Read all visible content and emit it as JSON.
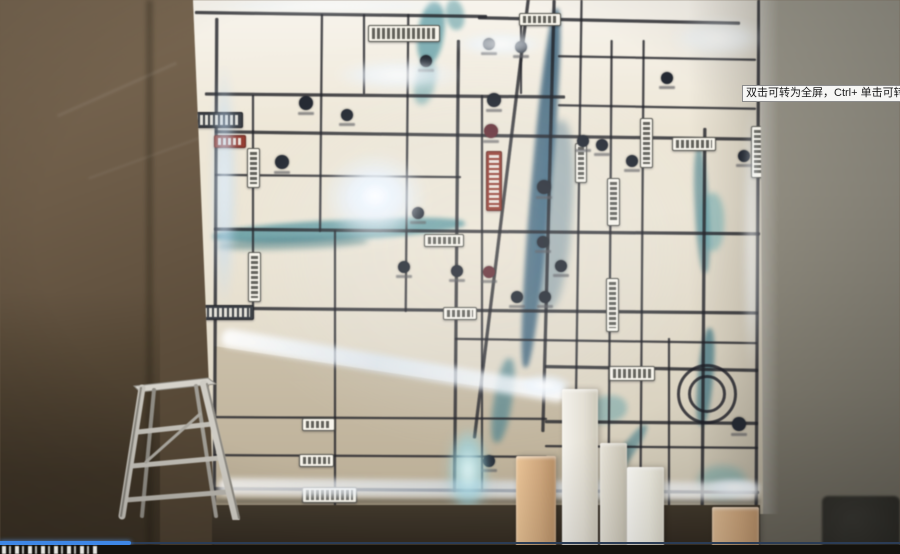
{
  "overlay": {
    "tooltip_text": "双击可转为全屏，Ctrl+ 单击可转为",
    "progress": {
      "fraction": 0.146,
      "bar_color": "#3e87e6",
      "track_color": "#2b3c55"
    }
  },
  "palette": {
    "wall_brown": "#6e5c46",
    "wall_gray": "#908c7f",
    "map_white": "#ece5d4",
    "map_tan": "#c5b8a0",
    "road_dark": "#23242a",
    "river_teal": "#47909b",
    "river_blue": "#2e5a78",
    "led_white": "#ffffff",
    "led_cyan": "#aadeea",
    "sign_red": "#9a3d31",
    "logo_dark": "#252a34",
    "logo_maroon": "#6a3038"
  },
  "map": {
    "v_roads": [
      [
        214,
        18,
        492,
        3,
        0.3
      ],
      [
        252,
        95,
        212,
        2,
        0
      ],
      [
        320,
        14,
        218,
        2,
        0.5
      ],
      [
        334,
        230,
        278,
        2,
        0
      ],
      [
        363,
        14,
        80,
        2,
        0
      ],
      [
        406,
        14,
        298,
        2,
        0.5
      ],
      [
        455,
        40,
        452,
        2.5,
        0.5
      ],
      [
        481,
        95,
        397,
        2,
        0
      ],
      [
        520,
        14,
        80,
        2,
        0
      ],
      [
        547,
        0,
        432,
        3,
        1.5
      ],
      [
        577,
        0,
        508,
        2,
        0.8
      ],
      [
        609,
        40,
        468,
        2,
        0.4
      ],
      [
        641,
        40,
        468,
        2,
        0.4
      ],
      [
        668,
        338,
        170,
        2,
        0
      ],
      [
        702,
        128,
        382,
        2.5,
        0.4
      ],
      [
        756,
        0,
        510,
        3,
        0.3
      ],
      [
        500,
        -5,
        445,
        3,
        7
      ]
    ],
    "h_roads": [
      [
        195,
        13,
        292,
        3,
        0.8
      ],
      [
        478,
        19,
        262,
        2.5,
        1.2
      ],
      [
        558,
        57,
        198,
        2,
        1
      ],
      [
        205,
        94,
        360,
        3,
        0.5
      ],
      [
        558,
        106,
        198,
        2,
        1
      ],
      [
        215,
        134,
        542,
        2.5,
        0.8
      ],
      [
        215,
        175,
        246,
        2,
        0.5
      ],
      [
        214,
        230,
        546,
        3,
        0.5
      ],
      [
        196,
        309,
        562,
        3,
        0.5
      ],
      [
        455,
        340,
        302,
        2,
        0.8
      ],
      [
        545,
        367,
        213,
        2.5,
        1
      ],
      [
        214,
        417,
        333,
        2,
        0.3
      ],
      [
        545,
        421,
        213,
        2.5,
        0.5
      ],
      [
        545,
        446,
        213,
        2,
        0.5
      ],
      [
        214,
        455,
        333,
        2,
        0.3
      ],
      [
        214,
        489,
        545,
        3,
        0.4
      ]
    ],
    "rivers": [
      [
        213,
        220,
        252,
        20,
        -3,
        "#47909b",
        0.75,
        2
      ],
      [
        218,
        238,
        150,
        11,
        -2,
        "#2f6f7a",
        0.5,
        3
      ],
      [
        418,
        2,
        26,
        62,
        8,
        "#4f98a3",
        0.7,
        2
      ],
      [
        446,
        0,
        18,
        30,
        -10,
        "#4f98a3",
        0.55,
        2
      ],
      [
        415,
        60,
        20,
        45,
        12,
        "#4f98a3",
        0.5,
        3
      ],
      [
        531,
        8,
        20,
        360,
        5,
        "#2e5a78",
        0.8,
        2
      ],
      [
        536,
        120,
        36,
        190,
        4,
        "#3b6a88",
        0.4,
        4
      ],
      [
        494,
        358,
        18,
        85,
        9,
        "#3f7d8c",
        0.65,
        3
      ],
      [
        695,
        148,
        14,
        125,
        -3,
        "#3f7d8c",
        0.6,
        2
      ],
      [
        700,
        193,
        24,
        58,
        0,
        "#58a3ab",
        0.5,
        3
      ],
      [
        698,
        328,
        15,
        98,
        5,
        "#35707f",
        0.7,
        2
      ],
      [
        618,
        418,
        13,
        75,
        35,
        "#3f7d8c",
        0.6,
        2
      ],
      [
        585,
        396,
        42,
        27,
        -10,
        "#4f98a3",
        0.45,
        3
      ],
      [
        698,
        466,
        48,
        32,
        0,
        "#58a3ab",
        0.45,
        4
      ]
    ],
    "glows": [
      [
        375,
        198,
        52,
        46,
        0.97,
        4,
        "w"
      ],
      [
        375,
        196,
        30,
        26,
        1,
        1,
        "w"
      ],
      [
        398,
        75,
        64,
        16,
        0.85,
        4,
        "w"
      ],
      [
        224,
        185,
        13,
        125,
        0.8,
        4,
        "b"
      ],
      [
        500,
        44,
        46,
        13,
        0.8,
        3,
        "w"
      ],
      [
        718,
        38,
        48,
        20,
        0.7,
        5,
        "w"
      ],
      [
        752,
        240,
        9,
        140,
        0.55,
        4,
        "w"
      ],
      [
        545,
        385,
        28,
        12,
        0.9,
        2,
        "w"
      ],
      [
        468,
        470,
        20,
        42,
        0.9,
        3,
        "c"
      ],
      [
        468,
        472,
        26,
        50,
        0.6,
        5,
        "c"
      ],
      [
        330,
        6,
        140,
        8,
        0.6,
        3,
        "w"
      ],
      [
        735,
        487,
        30,
        10,
        0.8,
        2,
        "w"
      ],
      [
        480,
        250,
        260,
        200,
        0.16,
        10,
        "w"
      ]
    ],
    "bands": [
      {
        "x": 222,
        "y": 328,
        "w": 348,
        "h": 18,
        "rot": 9.5,
        "opacity": 0.92
      },
      {
        "x": 218,
        "y": 478,
        "w": 540,
        "h": 17,
        "rot": 0.5,
        "opacity": 0.85
      }
    ],
    "labels": [
      [
        368,
        25,
        70,
        15,
        "light",
        "h"
      ],
      [
        181,
        112,
        60,
        14,
        "route",
        "h"
      ],
      [
        214,
        135,
        30,
        11,
        "red",
        "h"
      ],
      [
        247,
        148,
        11,
        38,
        "light",
        "v"
      ],
      [
        248,
        252,
        11,
        48,
        "light",
        "v"
      ],
      [
        195,
        305,
        57,
        13,
        "dark",
        "h"
      ],
      [
        302,
        418,
        31,
        11,
        "light",
        "h"
      ],
      [
        299,
        454,
        33,
        11,
        "light",
        "h"
      ],
      [
        302,
        487,
        53,
        14,
        "light",
        "h"
      ],
      [
        486,
        151,
        14,
        58,
        "red",
        "v"
      ],
      [
        443,
        307,
        32,
        11,
        "light",
        "h"
      ],
      [
        607,
        178,
        11,
        46,
        "light",
        "v"
      ],
      [
        606,
        278,
        11,
        52,
        "light",
        "v"
      ],
      [
        640,
        118,
        11,
        48,
        "light",
        "v"
      ],
      [
        609,
        366,
        44,
        13,
        "light",
        "h"
      ],
      [
        672,
        137,
        42,
        12,
        "light",
        "h"
      ],
      [
        751,
        126,
        12,
        50,
        "light",
        "v"
      ],
      [
        424,
        234,
        38,
        11,
        "light",
        "h"
      ],
      [
        575,
        143,
        10,
        38,
        "light",
        "v"
      ],
      [
        519,
        13,
        40,
        11,
        "light",
        "h"
      ]
    ],
    "logos": [
      [
        306,
        103,
        7,
        0
      ],
      [
        347,
        115,
        6,
        0
      ],
      [
        282,
        162,
        7,
        0
      ],
      [
        418,
        213,
        6,
        0
      ],
      [
        494,
        100,
        7,
        0
      ],
      [
        491,
        131,
        7,
        1
      ],
      [
        544,
        187,
        7,
        0
      ],
      [
        583,
        141,
        6,
        0
      ],
      [
        602,
        145,
        6,
        0
      ],
      [
        632,
        161,
        6,
        0
      ],
      [
        543,
        242,
        6,
        0
      ],
      [
        561,
        266,
        6,
        0
      ],
      [
        545,
        297,
        6,
        0
      ],
      [
        457,
        271,
        6,
        0
      ],
      [
        404,
        267,
        6,
        0
      ],
      [
        489,
        272,
        6,
        1
      ],
      [
        517,
        297,
        6,
        0
      ],
      [
        744,
        156,
        6,
        0
      ],
      [
        739,
        424,
        7,
        0
      ],
      [
        610,
        454,
        6,
        0
      ],
      [
        489,
        461,
        6,
        0
      ],
      [
        426,
        61,
        6,
        0
      ],
      [
        489,
        44,
        6,
        0
      ],
      [
        521,
        47,
        6,
        0
      ],
      [
        667,
        78,
        6,
        0
      ]
    ],
    "roundabout": {
      "cx": 704,
      "cy": 391,
      "outer_r": 27,
      "inner_r": 16
    }
  },
  "foreground": {
    "blocks": [
      [
        516,
        456,
        40,
        89,
        "#ecc493",
        "#d2a87a",
        "#b98f63"
      ],
      [
        562,
        389,
        36,
        156,
        "#f4f2eb",
        "#e4e0d4",
        "#cdc8b8"
      ],
      [
        600,
        443,
        27,
        102,
        "#eae6da",
        "#d6d1c2",
        "#c6c1b1"
      ],
      [
        627,
        467,
        37,
        78,
        "#fcfbf7",
        "#efede1",
        "#dbd7c8"
      ],
      [
        712,
        507,
        47,
        38,
        "#e4be92",
        "#cfa578",
        "#bb9166"
      ]
    ],
    "dark_corner": {
      "x": 822,
      "y": 496,
      "w": 78,
      "h": 58
    }
  }
}
